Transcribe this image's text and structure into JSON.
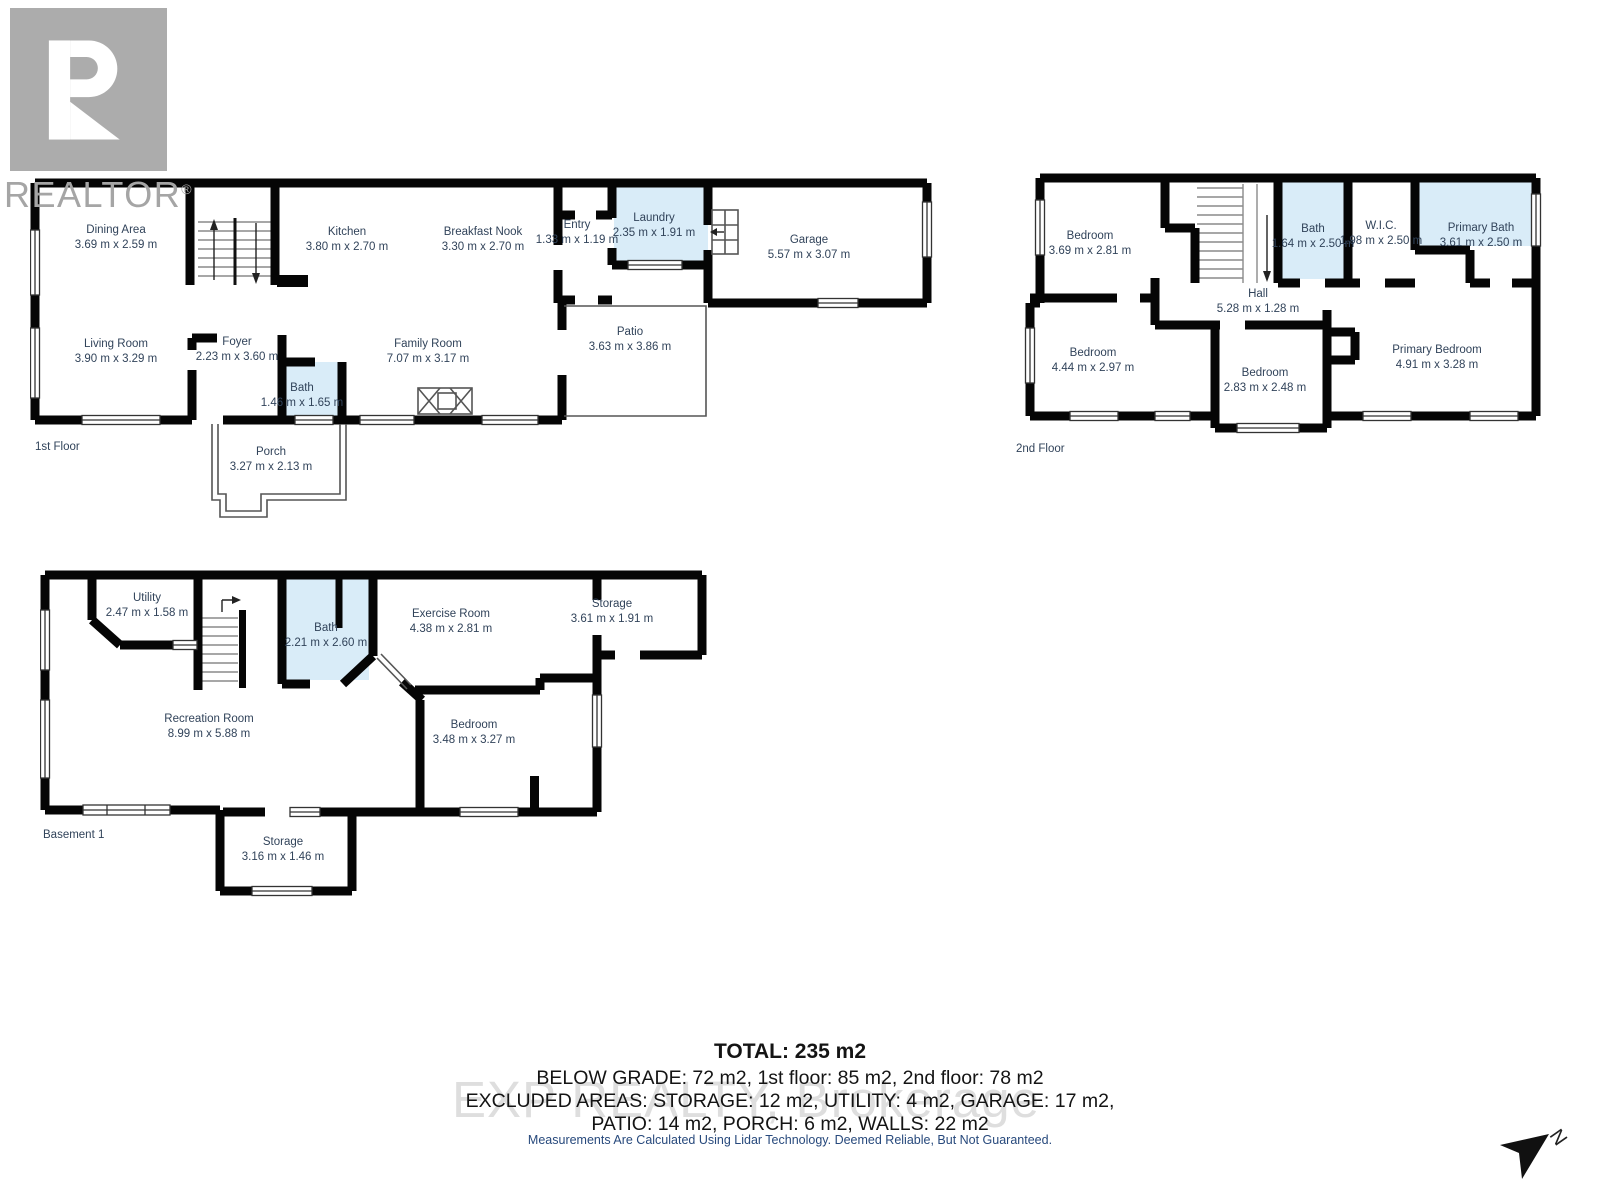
{
  "logo": {
    "letter": "R",
    "text": "REALTOR",
    "registered": "®"
  },
  "floors": {
    "first": {
      "label": "1st Floor",
      "rooms": [
        {
          "name": "Dining Area",
          "dims": "3.69 m x 2.59 m"
        },
        {
          "name": "Kitchen",
          "dims": "3.80 m x 2.70 m"
        },
        {
          "name": "Breakfast Nook",
          "dims": "3.30 m x 2.70 m"
        },
        {
          "name": "Entry",
          "dims": "1.33 m x 1.19 m"
        },
        {
          "name": "Laundry",
          "dims": "2.35 m x 1.91 m"
        },
        {
          "name": "Garage",
          "dims": "5.57 m x 3.07 m"
        },
        {
          "name": "Living Room",
          "dims": "3.90 m x 3.29 m"
        },
        {
          "name": "Foyer",
          "dims": "2.23 m x 3.60 m"
        },
        {
          "name": "Bath",
          "dims": "1.46 m x 1.65 m"
        },
        {
          "name": "Family Room",
          "dims": "7.07 m x 3.17 m"
        },
        {
          "name": "Patio",
          "dims": "3.63 m x 3.86 m"
        },
        {
          "name": "Porch",
          "dims": "3.27 m x 2.13 m"
        }
      ]
    },
    "second": {
      "label": "2nd Floor",
      "rooms": [
        {
          "name": "Bedroom",
          "dims": "3.69 m x 2.81 m"
        },
        {
          "name": "Bath",
          "dims": "1.64 m x 2.50 m"
        },
        {
          "name": "W.I.C.",
          "dims": "1.98 m x 2.50 m"
        },
        {
          "name": "Primary Bath",
          "dims": "3.61 m x 2.50 m"
        },
        {
          "name": "Hall",
          "dims": "5.28 m x 1.28 m"
        },
        {
          "name": "Bedroom",
          "dims": "4.44 m x 2.97 m"
        },
        {
          "name": "Bedroom",
          "dims": "2.83 m x 2.48 m"
        },
        {
          "name": "Primary Bedroom",
          "dims": "4.91 m x 3.28 m"
        }
      ]
    },
    "basement": {
      "label": "Basement 1",
      "rooms": [
        {
          "name": "Utility",
          "dims": "2.47 m x 1.58 m"
        },
        {
          "name": "Bath",
          "dims": "2.21 m x 2.60 m"
        },
        {
          "name": "Exercise Room",
          "dims": "4.38 m x 2.81 m"
        },
        {
          "name": "Storage",
          "dims": "3.61 m x 1.91 m"
        },
        {
          "name": "Recreation Room",
          "dims": "8.99 m x 5.88 m"
        },
        {
          "name": "Bedroom",
          "dims": "3.48 m x 3.27 m"
        },
        {
          "name": "Storage",
          "dims": "3.16 m x 1.46 m"
        }
      ]
    }
  },
  "summary": {
    "total": "TOTAL: 235 m2",
    "lines": [
      "BELOW GRADE: 72 m2, 1st floor: 85 m2, 2nd floor: 78 m2",
      "EXCLUDED AREAS: STORAGE: 12 m2, UTILITY: 4 m2, GARAGE: 17 m2,",
      "PATIO: 14 m2, PORCH: 6 m2, WALLS: 22 m2"
    ]
  },
  "watermark": "EXP REALTY, Brokerage",
  "disclaimer": "Measurements Are Calculated Using Lidar Technology. Deemed Reliable, But Not Guaranteed.",
  "compass": {
    "label": "N"
  },
  "colors": {
    "wall": "#050505",
    "wet_room_fill": "#d9ecf8",
    "label_text": "#31435a",
    "watermark": "#dedede",
    "disclaimer_text": "#27497c",
    "logo_gray": "#acacac"
  }
}
